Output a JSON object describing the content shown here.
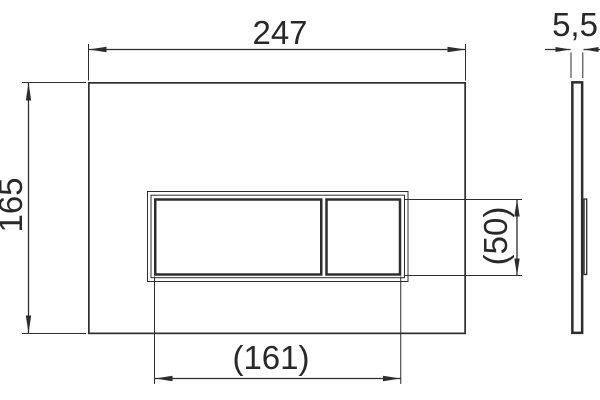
{
  "drawing": {
    "background_color": "#ffffff",
    "line_color": "#2d2d2d",
    "text_color": "#282828",
    "front_view": {
      "dimensions": {
        "overall_width": "247",
        "overall_height": "165",
        "button_panel_width": "(161)",
        "button_panel_height": "(50)"
      }
    },
    "side_view": {
      "dimensions": {
        "thickness": "5,5"
      }
    }
  }
}
